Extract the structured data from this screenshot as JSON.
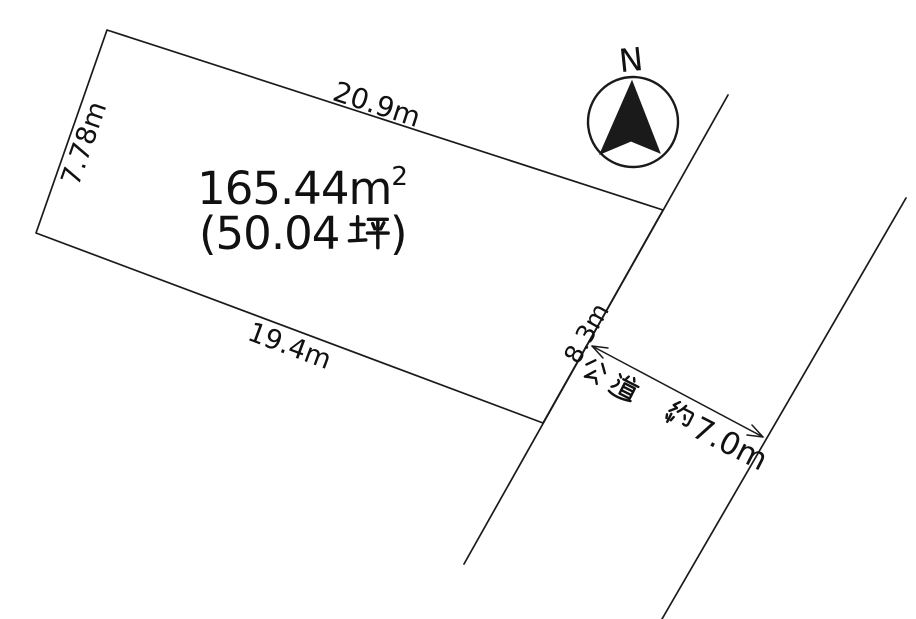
{
  "parcel": {
    "area_sqm": "165.44m²",
    "area_sqm_base": "165.44m",
    "area_sqm_sup": "2",
    "area_tsubo": "(50.04坪)",
    "area_tsubo_open": "(50.04",
    "area_tsubo_unit": "坪",
    "area_tsubo_close": ")",
    "dimensions": {
      "top": "20.9m",
      "left": "7.78m",
      "bottom": "19.4m",
      "right": "8.3m"
    }
  },
  "road": {
    "name": "公道",
    "width_prefix": "約",
    "width_value": "7.0m",
    "label": "公道 約7.0m"
  },
  "compass": {
    "label": "N"
  },
  "colors": {
    "background": "#ffffff",
    "line": "#1a1a1a",
    "text": "#111111"
  }
}
